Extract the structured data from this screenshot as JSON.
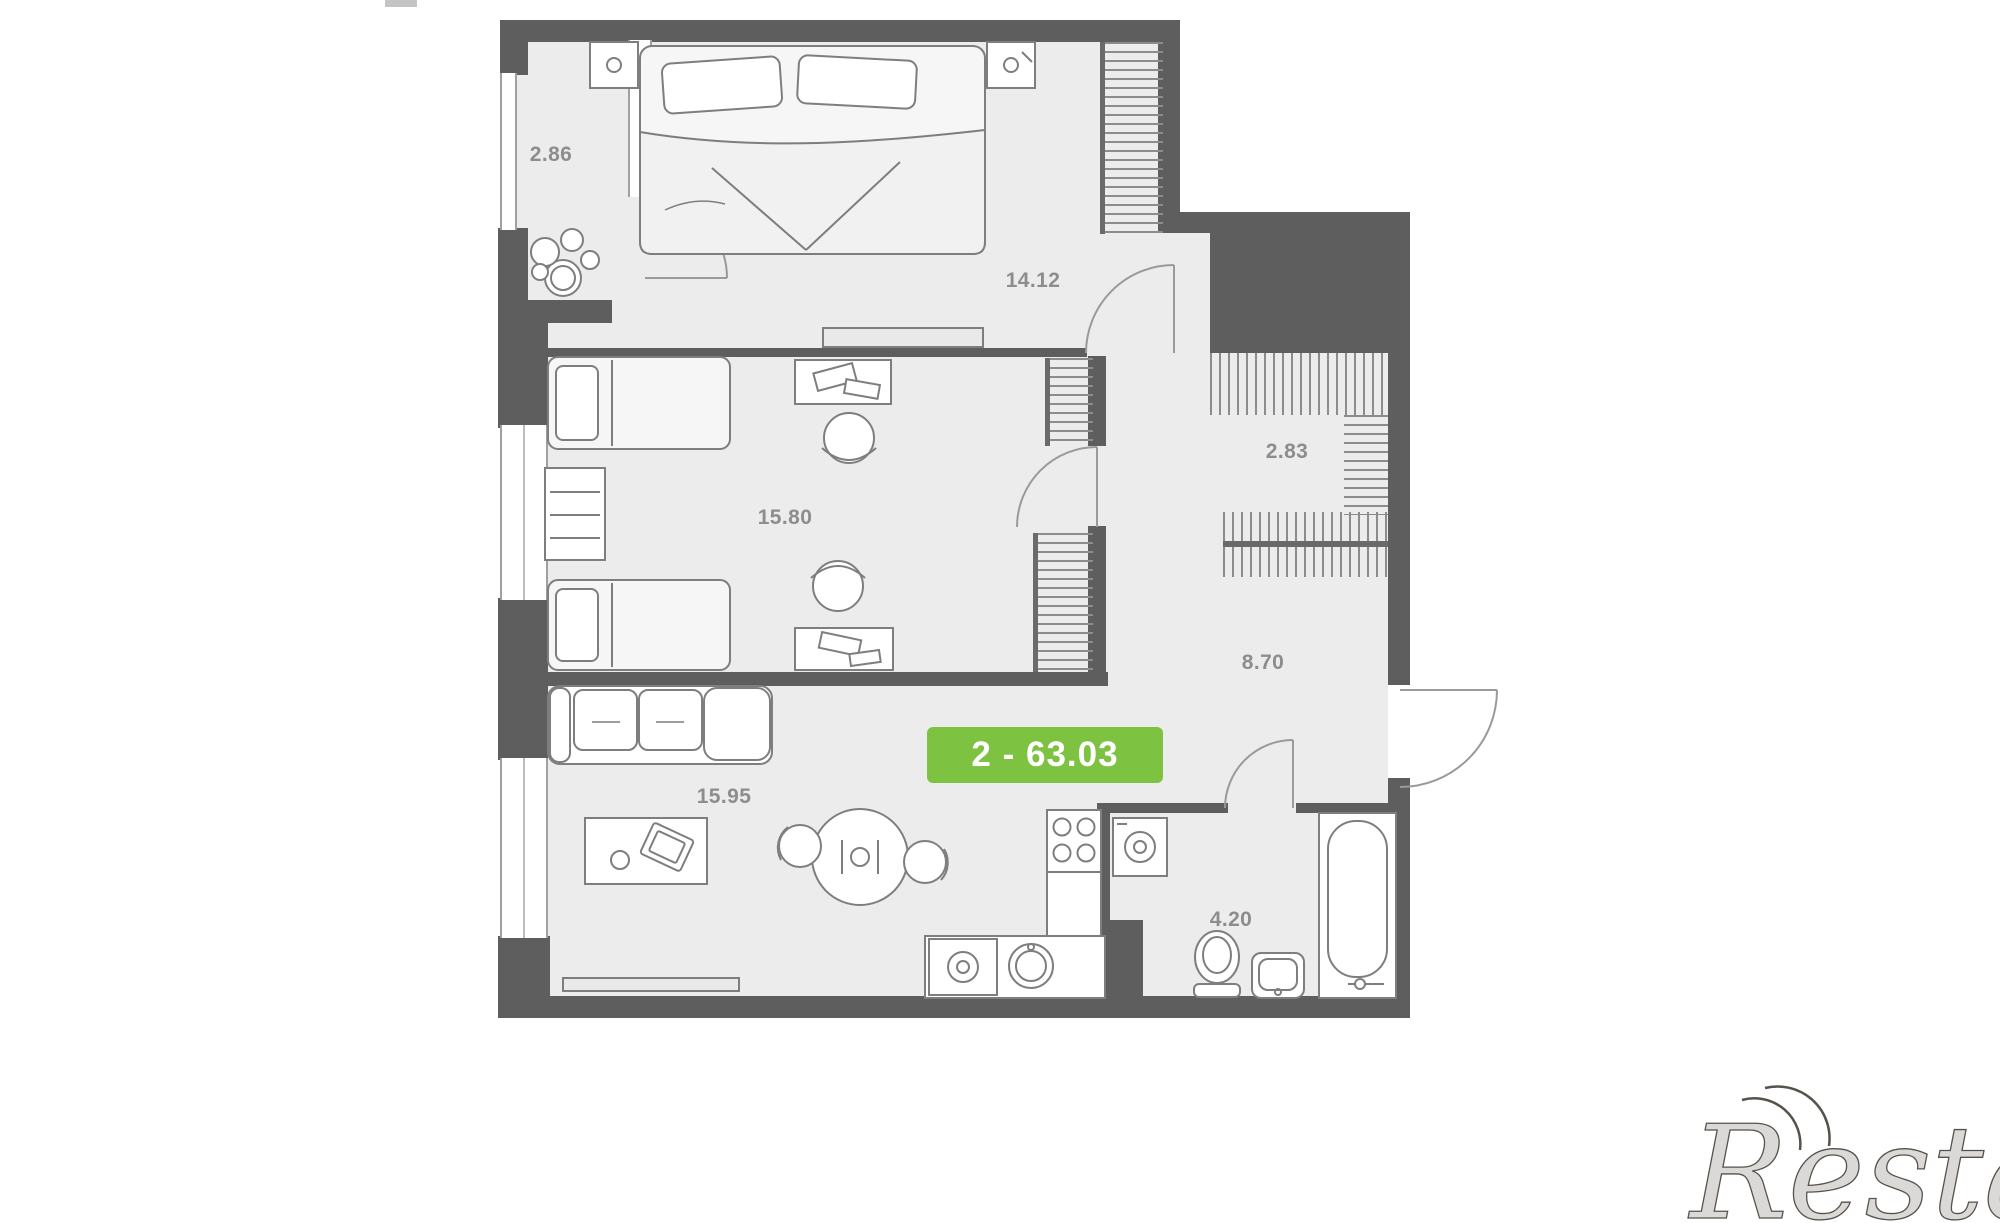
{
  "page": {
    "type": "apartment-floor-plan",
    "background": "#ffffff"
  },
  "colors": {
    "wall": "#5e5e5e",
    "floor": "#ececec",
    "furniture_line": "#7e7e7e",
    "window_line": "#a0a0a0",
    "label_text": "#8d8d8d",
    "badge_background": "#7ec242",
    "badge_text": "#ffffff",
    "watermark_text": "#56514b"
  },
  "badge": {
    "text": "2 - 63.03"
  },
  "watermark": {
    "text": "Restate"
  },
  "rooms": [
    {
      "id": "balcony",
      "area": "2.86",
      "furniture": [
        "plant-icon",
        "glazing-window",
        "balcony-door-arc"
      ]
    },
    {
      "id": "bedroom",
      "area": "14.12",
      "furniture": [
        "double-bed-icon",
        "nightstand-icon",
        "nightstand-icon",
        "wardrobe-hatch-icon",
        "tv-console-icon",
        "door-arc"
      ]
    },
    {
      "id": "kids-room",
      "area": "15.80",
      "furniture": [
        "single-bed-icon",
        "single-bed-icon",
        "dresser-icon",
        "desk-icon",
        "chair-icon",
        "desk-icon",
        "chair-icon",
        "wardrobe-hatch-icon",
        "wardrobe-hatch-icon",
        "door-arc"
      ]
    },
    {
      "id": "wardrobe",
      "area": "2.83",
      "furniture": [
        "clothes-rail-hatch-icon",
        "clothes-rail-hatch-icon"
      ]
    },
    {
      "id": "hallway",
      "area": "8.70",
      "furniture": [
        "double-clothes-rail-hatch-icon",
        "entrance-door-arc"
      ]
    },
    {
      "id": "living-kitchen",
      "area": "15.95",
      "furniture": [
        "sofa-icon",
        "coffee-table-icon",
        "dining-table-icon",
        "chair-icon",
        "chair-icon",
        "tv-console-icon",
        "stove-icon",
        "kitchen-counter-icon",
        "washing-machine-icon",
        "round-sink-icon"
      ]
    },
    {
      "id": "bathroom",
      "area": "4.20",
      "furniture": [
        "washing-machine-icon",
        "toilet-icon",
        "sink-icon",
        "bathtub-icon",
        "door-arc"
      ]
    }
  ]
}
